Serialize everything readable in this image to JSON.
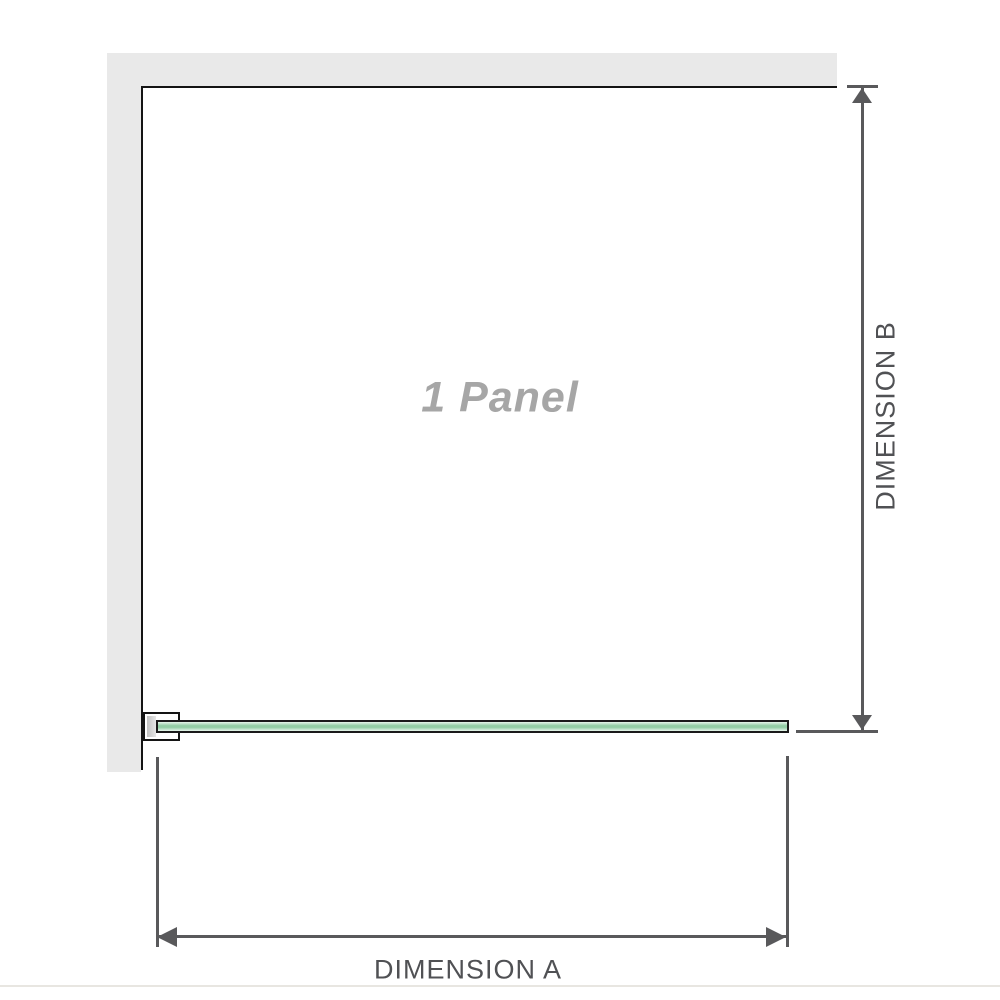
{
  "diagram": {
    "panel_label": "1 Panel",
    "dimension_a": {
      "label": "DIMENSION A",
      "orientation": "horizontal"
    },
    "dimension_b": {
      "label": "DIMENSION B",
      "orientation": "vertical"
    }
  },
  "colors": {
    "wall": "#e9e9e9",
    "outline": "#141414",
    "dim": "#59595b",
    "dim_text": "#505154",
    "label": "#a6a6a6",
    "glass_border": "#1a1a1a",
    "glass_light": "#e7f5ec",
    "glass_mid": "#93cea5",
    "glass_soft": "#c9e8d3",
    "gasket": "#c2c2c2",
    "faint": "#e8e6e1"
  }
}
